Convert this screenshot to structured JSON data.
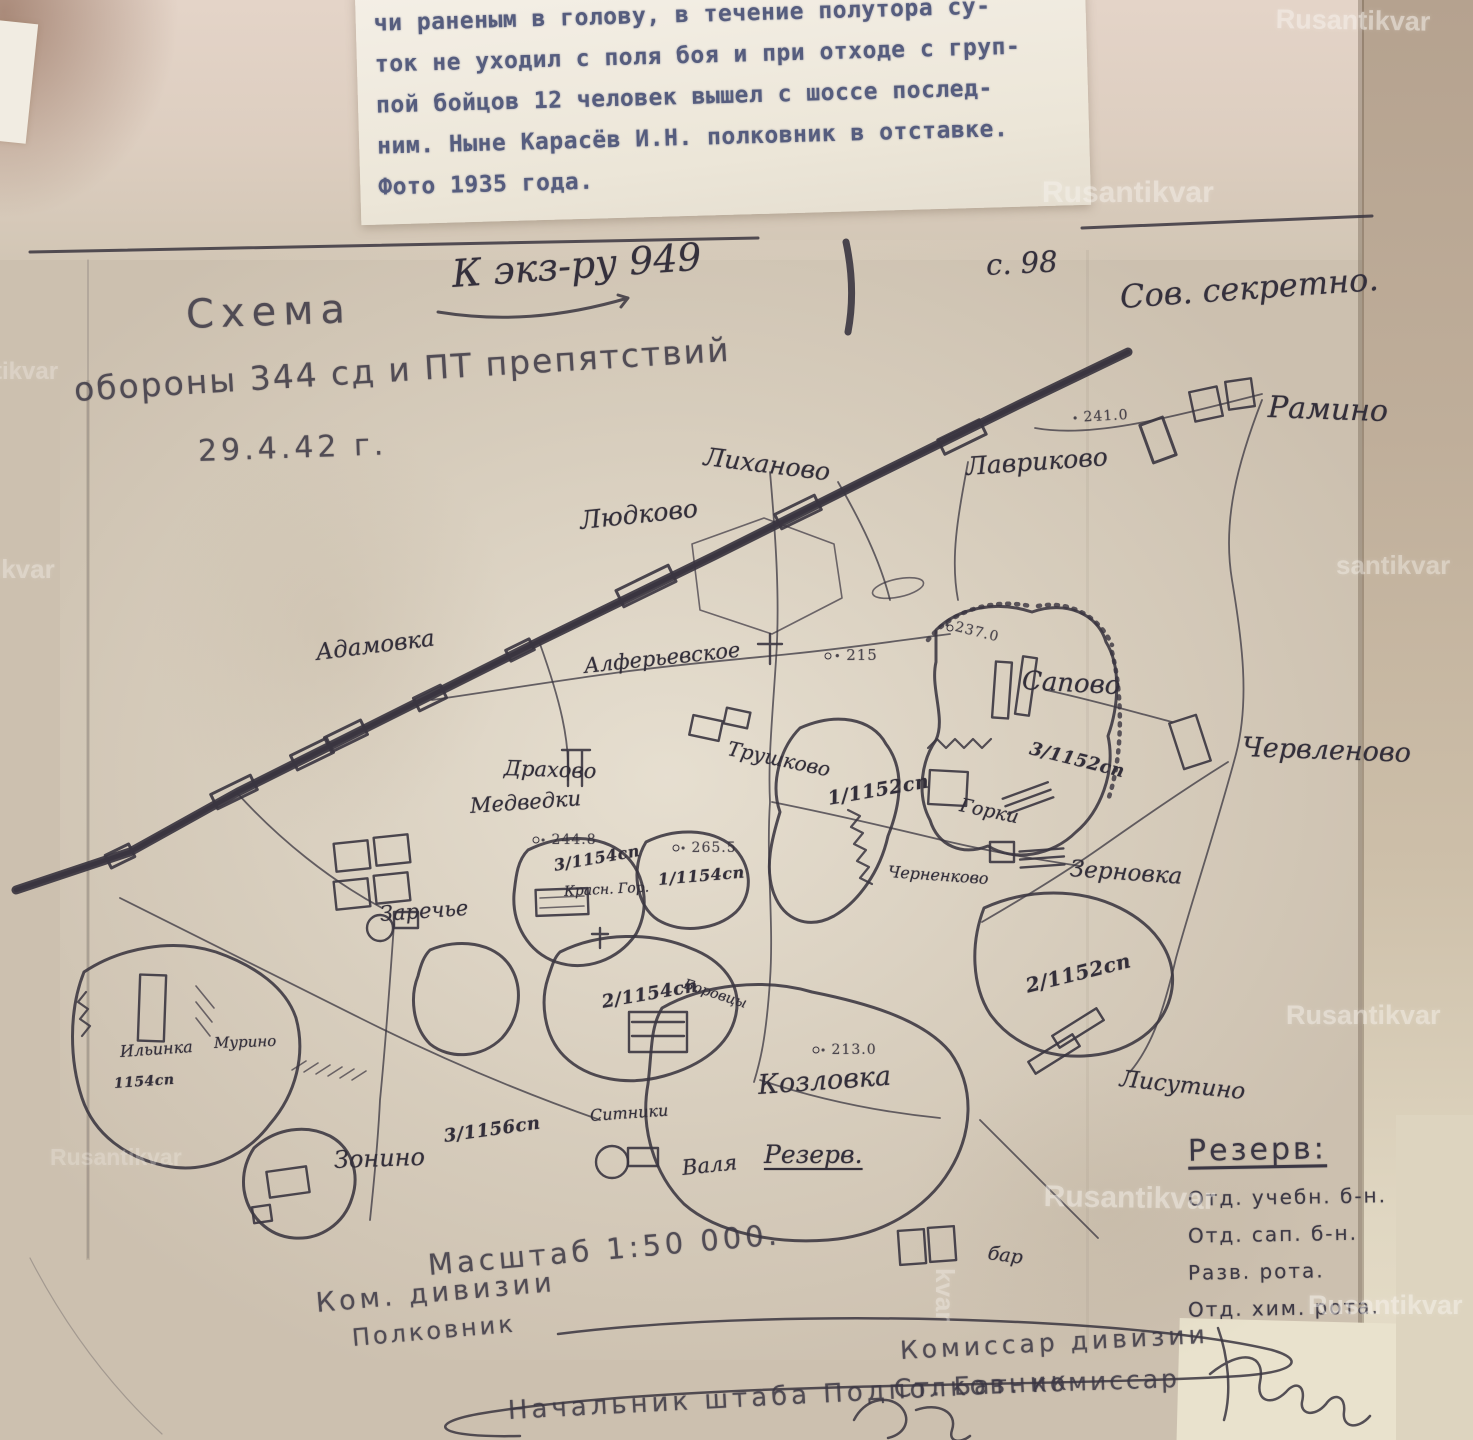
{
  "caption_card": {
    "lines": [
      "чи раненым в голову, в течение полутора су-",
      "ток не уходил с поля боя и при отходе с груп-",
      "пой бойцов 12 человек вышел с шоссе послед-",
      "ним. Ныне Карасёв И.Н. полковник в отставке.",
      "Фото 1935 года."
    ]
  },
  "header": {
    "copy_note": "К экз-ру 949",
    "page_note": "с. 98",
    "secrecy": "Сов. секретно."
  },
  "title": {
    "line1": "Схема",
    "line2": "обороны 344 сд и ПТ препятствий",
    "line3": "29.4.42 г."
  },
  "map": {
    "labels": [
      {
        "t": "Рамино",
        "x": 1268,
        "y": 390,
        "s": 30,
        "r": 2
      },
      {
        "t": "241.0",
        "x": 1072,
        "y": 410,
        "s": 14,
        "r": -3,
        "c": "elev"
      },
      {
        "t": "Лавриково",
        "x": 966,
        "y": 452,
        "s": 25,
        "r": -4
      },
      {
        "t": "Лиханово",
        "x": 704,
        "y": 442,
        "s": 25,
        "r": 7
      },
      {
        "t": "Людково",
        "x": 580,
        "y": 506,
        "s": 25,
        "r": -6
      },
      {
        "t": "Адамовка",
        "x": 316,
        "y": 640,
        "s": 23,
        "r": -7
      },
      {
        "t": "Алферьевское",
        "x": 584,
        "y": 654,
        "s": 21,
        "r": -6
      },
      {
        "t": "215",
        "x": 834,
        "y": 646,
        "s": 15,
        "r": 0,
        "c": "elev"
      },
      {
        "t": "237.0",
        "x": 944,
        "y": 616,
        "s": 14,
        "r": 14,
        "c": "elev"
      },
      {
        "t": "Сапово",
        "x": 1022,
        "y": 666,
        "s": 26,
        "r": 3
      },
      {
        "t": "3/1152сп",
        "x": 1030,
        "y": 738,
        "s": 18,
        "r": 14,
        "c": "unit"
      },
      {
        "t": "Червленово",
        "x": 1242,
        "y": 732,
        "s": 27,
        "r": 2
      },
      {
        "t": "Трушково",
        "x": 728,
        "y": 736,
        "s": 20,
        "r": 12
      },
      {
        "t": "Драхово",
        "x": 504,
        "y": 756,
        "s": 21,
        "r": 2
      },
      {
        "t": "Медведки",
        "x": 470,
        "y": 794,
        "s": 21,
        "r": -4
      },
      {
        "t": "244.8",
        "x": 540,
        "y": 832,
        "s": 14,
        "r": 0,
        "c": "elev"
      },
      {
        "t": "3/1154сп",
        "x": 554,
        "y": 856,
        "s": 16,
        "r": -10,
        "c": "unit"
      },
      {
        "t": "Красн. Гор.",
        "x": 564,
        "y": 884,
        "s": 14,
        "r": -3
      },
      {
        "t": "265.5",
        "x": 680,
        "y": 840,
        "s": 14,
        "r": 0,
        "c": "elev"
      },
      {
        "t": "1/1154сп",
        "x": 658,
        "y": 870,
        "s": 16,
        "r": -5,
        "c": "unit"
      },
      {
        "t": "1/1152сп",
        "x": 828,
        "y": 788,
        "s": 19,
        "r": -10,
        "c": "unit"
      },
      {
        "t": "Горки",
        "x": 960,
        "y": 794,
        "s": 19,
        "r": 12
      },
      {
        "t": "Черненково",
        "x": 888,
        "y": 862,
        "s": 16,
        "r": 4
      },
      {
        "t": "Зерновка",
        "x": 1070,
        "y": 856,
        "s": 23,
        "r": 4
      },
      {
        "t": "Заречье",
        "x": 380,
        "y": 902,
        "s": 21,
        "r": -4
      },
      {
        "t": "2/1154сп",
        "x": 602,
        "y": 992,
        "s": 18,
        "r": -10,
        "c": "unit"
      },
      {
        "t": "Боровцы",
        "x": 684,
        "y": 976,
        "s": 14,
        "r": 18
      },
      {
        "t": "2/1152сп",
        "x": 1026,
        "y": 974,
        "s": 20,
        "r": -14,
        "c": "unit"
      },
      {
        "t": "Лисутино",
        "x": 1120,
        "y": 1066,
        "s": 23,
        "r": 6
      },
      {
        "t": "213.0",
        "x": 820,
        "y": 1042,
        "s": 14,
        "r": 0,
        "c": "elev"
      },
      {
        "t": "Козловка",
        "x": 758,
        "y": 1070,
        "s": 27,
        "r": -4
      },
      {
        "t": "Резерв.",
        "x": 764,
        "y": 1140,
        "s": 25,
        "r": 0,
        "c": "u"
      },
      {
        "t": "Валя",
        "x": 682,
        "y": 1156,
        "s": 21,
        "r": -6
      },
      {
        "t": "Ситники",
        "x": 590,
        "y": 1106,
        "s": 16,
        "r": -4
      },
      {
        "t": "Зонино",
        "x": 334,
        "y": 1146,
        "s": 24,
        "r": -2
      },
      {
        "t": "3/1156сп",
        "x": 444,
        "y": 1126,
        "s": 18,
        "r": -8,
        "c": "unit"
      },
      {
        "t": "Мурино",
        "x": 214,
        "y": 1034,
        "s": 15,
        "r": -2
      },
      {
        "t": "Ильинка",
        "x": 120,
        "y": 1042,
        "s": 16,
        "r": -4
      },
      {
        "t": "1154сп",
        "x": 114,
        "y": 1076,
        "s": 14,
        "r": -4,
        "c": "unit"
      },
      {
        "t": "бар",
        "x": 988,
        "y": 1242,
        "s": 19,
        "r": 8
      }
    ]
  },
  "reserve": {
    "header": "Резерв:",
    "items": [
      "Отд. учебн. б-н.",
      "Отд. сап. б-н.",
      "Разв. рота.",
      "Отд. хим. рота."
    ]
  },
  "footer": {
    "scale": "Масштаб 1:50 000.",
    "commander_role": "Ком. дивизии",
    "commander_rank": "Полковник",
    "commissar_role": "Комиссар дивизии",
    "commissar_rank": "Ст. Бат. комиссар",
    "chief_of_staff": "Начальник штаба Подполковник"
  },
  "watermarks": [
    {
      "t": "Rusantikvar",
      "x": 1276,
      "y": 4,
      "s": 27,
      "r": 1,
      "o": 0.55
    },
    {
      "t": "Rusantikvar",
      "x": 1042,
      "y": 176,
      "s": 30,
      "r": 0,
      "o": 0.5
    },
    {
      "t": "santikvar",
      "x": 1336,
      "y": 550,
      "s": 26,
      "r": 0,
      "o": 0.45
    },
    {
      "t": "tikvar",
      "x": -6,
      "y": 358,
      "s": 24,
      "r": 0,
      "o": 0.35
    },
    {
      "t": "ikvar",
      "x": -6,
      "y": 554,
      "s": 26,
      "r": 0,
      "o": 0.4
    },
    {
      "t": "Rusantikvar",
      "x": 1286,
      "y": 1000,
      "s": 27,
      "r": 0,
      "o": 0.5
    },
    {
      "t": "Rusantikvar",
      "x": 1044,
      "y": 1180,
      "s": 30,
      "r": 1,
      "o": 0.5
    },
    {
      "t": "Rusantikvar",
      "x": 1308,
      "y": 1290,
      "s": 27,
      "r": 0,
      "o": 0.55
    },
    {
      "t": "Rusantikvar",
      "x": 50,
      "y": 1144,
      "s": 23,
      "r": 0,
      "o": 0.3
    },
    {
      "t": "kvar",
      "x": 960,
      "y": 1268,
      "s": 26,
      "r": 90,
      "o": 0.4
    }
  ]
}
